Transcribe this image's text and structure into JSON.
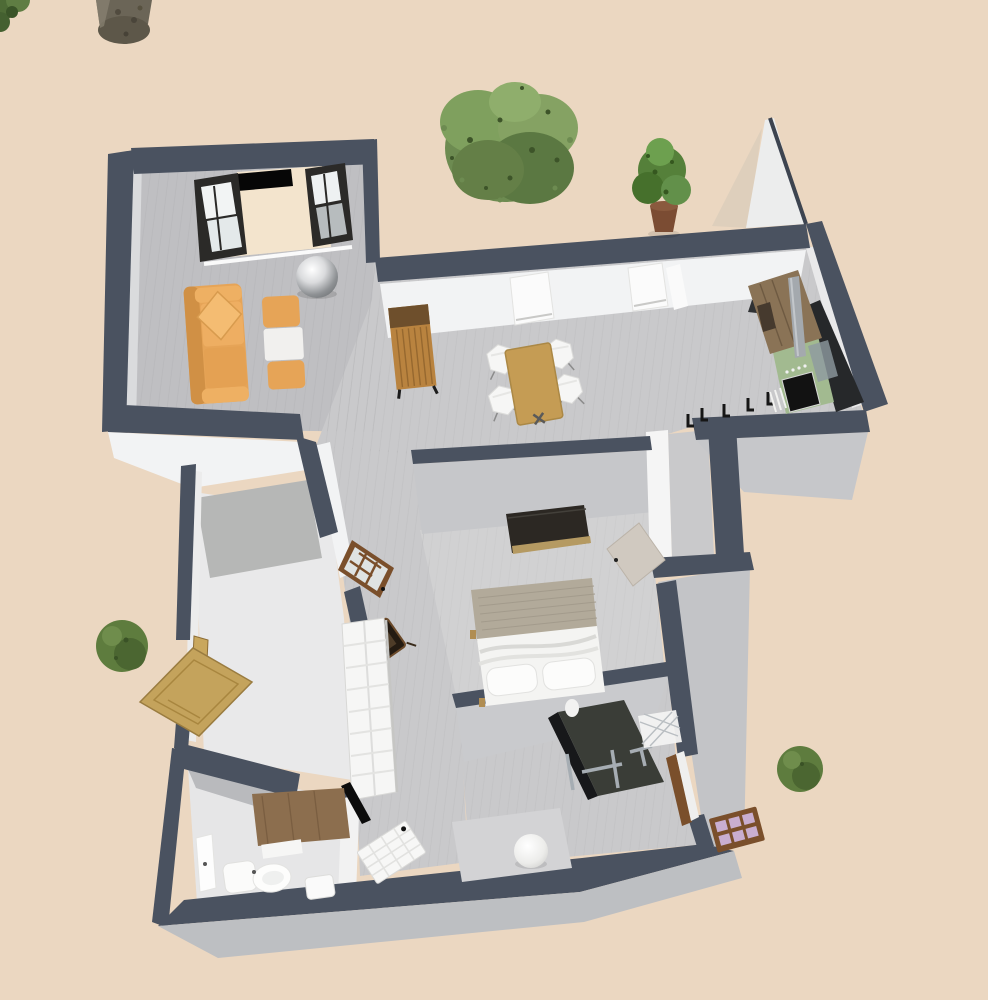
{
  "colors": {
    "background": "#ebd7c1",
    "wall_top": "#4a5260",
    "wall_outer": "#bdbfc2",
    "wall_face_light": "#f2f3f4",
    "wall_face_gray": "#c6c7ca",
    "floor_main": "#c9c9cb",
    "floor_living": "#bfbfc2",
    "floor_bedroom": "#d1d1d2",
    "floor_closet": "#e9e9ea",
    "floor_bath": "#e6e6e7",
    "sofa_orange": "#e6a457",
    "wood_tan": "#b9833f",
    "wood_dark": "#6e4f2c",
    "table_wood": "#c59c54",
    "door_tan": "#c4a35c",
    "frame_brown": "#7a4f2b",
    "stove_green": "#a2ba90",
    "counter_dark": "#26282a",
    "bed_blanket": "#b2aa9a",
    "fixture_white": "#fafafa",
    "tree_green": "#5e7c3e",
    "trunk_brown": "#6b6557",
    "pane_lavender": "#c9aed0",
    "metal_gray": "#a6adb3",
    "rug_gray": "#d3d3d5"
  }
}
